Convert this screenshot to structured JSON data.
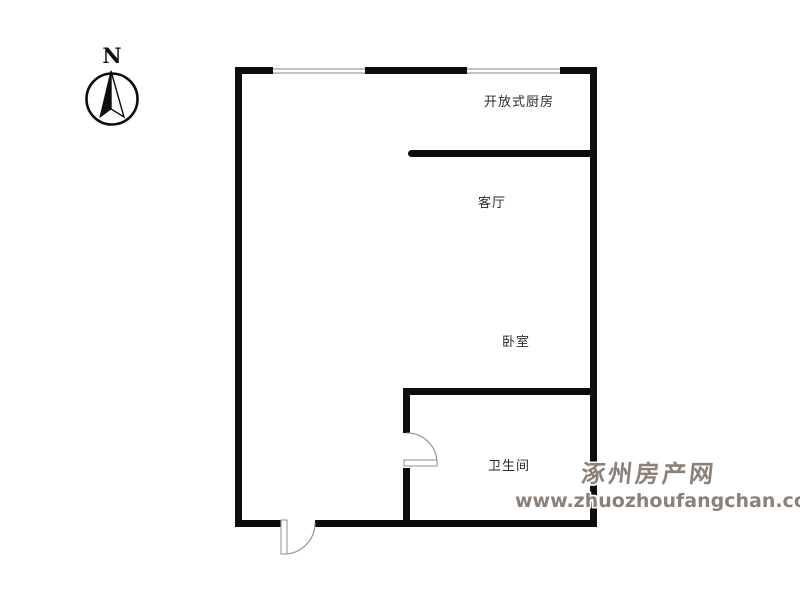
{
  "compass": {
    "label": "N"
  },
  "rooms": {
    "kitchen": {
      "label": "开放式厨房"
    },
    "living": {
      "label": "客厅"
    },
    "bedroom": {
      "label": "卧室"
    },
    "bathroom": {
      "label": "卫生间"
    }
  },
  "watermark": {
    "site_name": "涿州房产网",
    "site_url": "www.zhuozhoufangchan.com",
    "color": "#8b8179"
  },
  "colors": {
    "wall": "#0d0d0d",
    "window_line": "#c2c2c2",
    "door_outline": "#9a9a9a",
    "label_text": "#2b2b2b",
    "background": "#ffffff"
  }
}
